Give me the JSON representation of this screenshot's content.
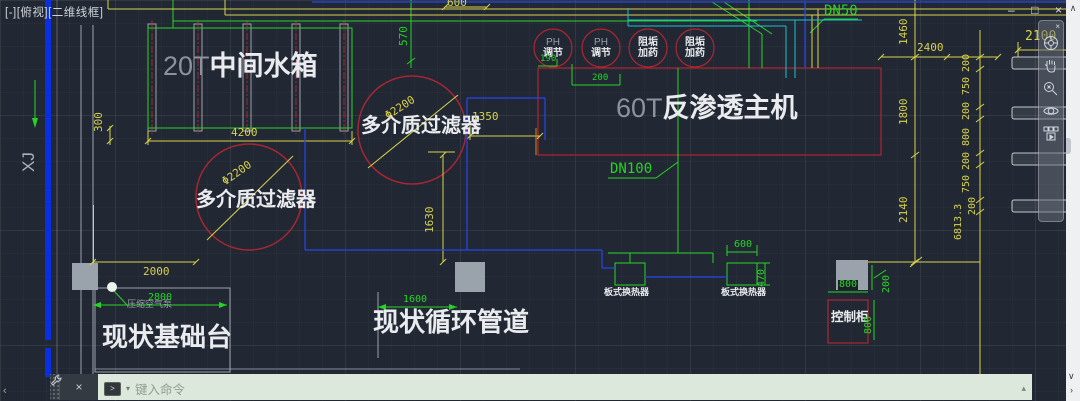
{
  "viewport_controls": {
    "label": "[-][俯视][二维线框]"
  },
  "window_controls": {
    "minimize": "–",
    "restore": "□",
    "close": "×"
  },
  "right_strip": {
    "chevron_up": "∧",
    "chevron_down": "∨",
    "chevron_right": "›"
  },
  "bottom_left": {
    "chevron_left": "‹"
  },
  "drawing": {
    "tank": {
      "prefix": "20T",
      "name": "中间水箱"
    },
    "filters": {
      "upper": "多介质过滤器",
      "lower": "多介质过滤器",
      "upper_dia": "Φ2200",
      "lower_dia": "Φ2200"
    },
    "ro_unit": {
      "prefix": "60T",
      "name": "反渗透主机"
    },
    "dosing": {
      "ph1_line1": "PH",
      "ph1_line2": "调节",
      "ph2_line1": "PH",
      "ph2_line2": "调节",
      "scale1_line1": "阻垢",
      "scale1_line2": "加药",
      "scale2_line1": "阻垢",
      "scale2_line2": "加药"
    },
    "pipes": {
      "dn50": "DN50",
      "dn100": "DN100"
    },
    "annotations": {
      "foundation": "现状基础台",
      "pipeline": "现状循环管道",
      "cabinet": "控制柜",
      "hx1": "板式换热器",
      "hx2": "板式换热器",
      "compressor": "压缩空气泵",
      "axis": "XJ"
    },
    "dims": {
      "top600": "600",
      "d4200": "4200",
      "d300": "300",
      "d570": "570",
      "d190": "190",
      "d200ph": "200",
      "d1350": "1350",
      "d1630": "1630",
      "d2000": "2000",
      "d2800": "2800",
      "d1600": "1600",
      "d600hx": "600",
      "d470": "470",
      "d800cab": "800",
      "d200cab": "200",
      "d800side": "800",
      "d2400": "2400",
      "d2100": "2100",
      "d1460": "1460",
      "d1800": "1800",
      "d2140": "2140",
      "c200a": "200",
      "c750a": "750",
      "c200b": "200",
      "c800": "800",
      "c200c": "200",
      "c750b": "750",
      "c200d": "200",
      "d6813": "6813.3"
    }
  },
  "command_line": {
    "placeholder": "键入命令",
    "prompt_symbol": ">",
    "dropdown": "▾",
    "expand": "▴",
    "close": "×"
  },
  "colors": {
    "background": "#212833",
    "dim_yellow": "#d8d24b",
    "dim_green": "#26d326",
    "pipe_blue": "#2746e8",
    "pipe_cyan": "#17c3cf",
    "equip_red": "#b02531",
    "wall_blue": "#0a2fe0"
  }
}
